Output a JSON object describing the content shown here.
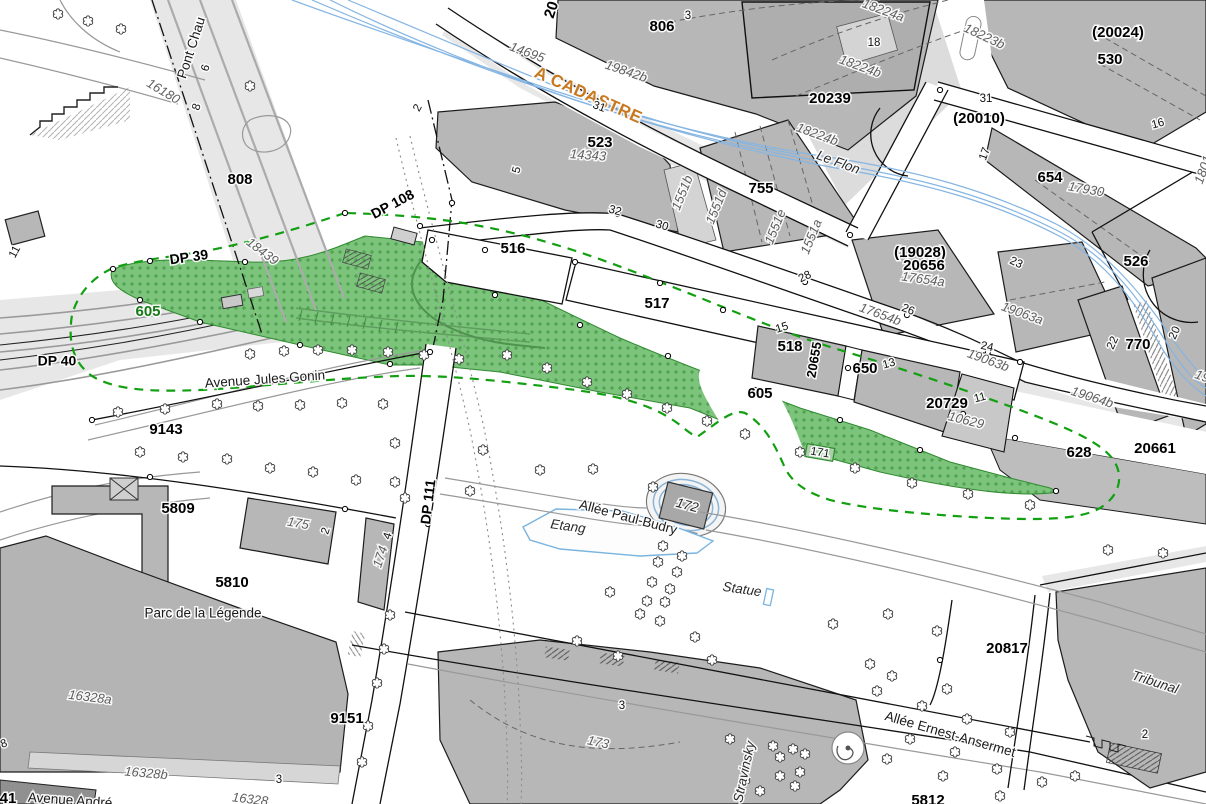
{
  "meta": {
    "kind": "cadastral-plan",
    "highlighted_parcel": "605",
    "river_name": "Le Flon",
    "park_name": "Parc de la Légende"
  },
  "colors": {
    "building": "#b7b7b7",
    "building_light": "#d4d4d4",
    "highlight_green": "#7cc47c",
    "highlight_green_mark": "#459a45",
    "green_boundary": "#12a012",
    "river_blue": "#85b5e3",
    "water_outline": "#7ab4e0",
    "cadastre_orange": "#c8791f",
    "green_label": "#157a15"
  },
  "labels": [
    {
      "t": "Pont Chau",
      "x": 192,
      "y": 48,
      "r": -72,
      "c": "street"
    },
    {
      "t": "6",
      "x": 206,
      "y": 68,
      "r": -72,
      "c": "num"
    },
    {
      "t": "16180",
      "x": 163,
      "y": 92,
      "r": 31,
      "c": "sub"
    },
    {
      "t": "8",
      "x": 197,
      "y": 107,
      "r": -72,
      "c": "num"
    },
    {
      "t": "808",
      "x": 240,
      "y": 180,
      "r": 0,
      "c": "parcel"
    },
    {
      "t": "18439",
      "x": 262,
      "y": 252,
      "r": 37,
      "c": "sub"
    },
    {
      "t": "DP 39",
      "x": 189,
      "y": 258,
      "r": -8,
      "c": "dp"
    },
    {
      "t": "DP 40",
      "x": 57,
      "y": 362,
      "r": 0,
      "c": "dp"
    },
    {
      "t": "11",
      "x": 15,
      "y": 252,
      "r": -62,
      "c": "num"
    },
    {
      "t": "605",
      "x": 148,
      "y": 312,
      "r": 0,
      "c": "green-label"
    },
    {
      "t": "DP 108",
      "x": 393,
      "y": 205,
      "r": -28,
      "c": "dp"
    },
    {
      "t": "Avenue Jules Gonin",
      "x": 265,
      "y": 380,
      "r": -4,
      "c": "street"
    },
    {
      "t": "9143",
      "x": 166,
      "y": 430,
      "r": 0,
      "c": "parcel"
    },
    {
      "t": "20",
      "x": 552,
      "y": 10,
      "r": -72,
      "c": "parcel"
    },
    {
      "t": "14695",
      "x": 527,
      "y": 53,
      "r": 20,
      "c": "sub"
    },
    {
      "t": "19842b",
      "x": 626,
      "y": 72,
      "r": 19,
      "c": "sub"
    },
    {
      "t": "A CADASTRE",
      "x": 588,
      "y": 96,
      "r": 24,
      "c": "cadastre"
    },
    {
      "t": "806",
      "x": 662,
      "y": 27,
      "r": 0,
      "c": "parcel"
    },
    {
      "t": "3",
      "x": 688,
      "y": 16,
      "r": 0,
      "c": "num"
    },
    {
      "t": "31",
      "x": 599,
      "y": 107,
      "r": 20,
      "c": "num"
    },
    {
      "t": "523",
      "x": 600,
      "y": 143,
      "r": 0,
      "c": "parcel"
    },
    {
      "t": "14343",
      "x": 588,
      "y": 156,
      "r": 4,
      "c": "sub"
    },
    {
      "t": "5",
      "x": 517,
      "y": 170,
      "r": -75,
      "c": "num"
    },
    {
      "t": "2",
      "x": 418,
      "y": 108,
      "r": -62,
      "c": "num"
    },
    {
      "t": "32",
      "x": 615,
      "y": 211,
      "r": 16,
      "c": "num"
    },
    {
      "t": "30",
      "x": 662,
      "y": 226,
      "r": 16,
      "c": "num"
    },
    {
      "t": "1551b",
      "x": 683,
      "y": 193,
      "r": -68,
      "c": "sub"
    },
    {
      "t": "1551d",
      "x": 717,
      "y": 207,
      "r": -68,
      "c": "sub"
    },
    {
      "t": "755",
      "x": 761,
      "y": 189,
      "r": 0,
      "c": "parcel"
    },
    {
      "t": "1551e",
      "x": 776,
      "y": 227,
      "r": -68,
      "c": "sub"
    },
    {
      "t": "1551a",
      "x": 812,
      "y": 237,
      "r": -68,
      "c": "sub"
    },
    {
      "t": "28",
      "x": 805,
      "y": 277,
      "r": -25,
      "c": "num"
    },
    {
      "t": "18224a",
      "x": 883,
      "y": 11,
      "r": 20,
      "c": "sub"
    },
    {
      "t": "18",
      "x": 874,
      "y": 43,
      "r": 0,
      "c": "num"
    },
    {
      "t": "18224b",
      "x": 860,
      "y": 67,
      "r": 20,
      "c": "sub"
    },
    {
      "t": "20239",
      "x": 830,
      "y": 99,
      "r": 0,
      "c": "parcel"
    },
    {
      "t": "18223b",
      "x": 984,
      "y": 37,
      "r": 25,
      "c": "sub"
    },
    {
      "t": "(20024)",
      "x": 1118,
      "y": 33,
      "r": 0,
      "c": "parcel"
    },
    {
      "t": "530",
      "x": 1110,
      "y": 60,
      "r": 0,
      "c": "parcel"
    },
    {
      "t": "18224b",
      "x": 817,
      "y": 135,
      "r": 20,
      "c": "sub"
    },
    {
      "t": "Le Flon",
      "x": 838,
      "y": 163,
      "r": 20,
      "c": "street-it"
    },
    {
      "t": "31",
      "x": 986,
      "y": 99,
      "r": 0,
      "c": "num"
    },
    {
      "t": "(20010)",
      "x": 979,
      "y": 119,
      "r": 0,
      "c": "parcel"
    },
    {
      "t": "16",
      "x": 1158,
      "y": 124,
      "r": -15,
      "c": "num"
    },
    {
      "t": "17",
      "x": 985,
      "y": 154,
      "r": -70,
      "c": "num"
    },
    {
      "t": "654",
      "x": 1050,
      "y": 178,
      "r": 0,
      "c": "parcel"
    },
    {
      "t": "17930",
      "x": 1086,
      "y": 190,
      "r": 10,
      "c": "sub"
    },
    {
      "t": "1801",
      "x": 1204,
      "y": 170,
      "r": -70,
      "c": "sub"
    },
    {
      "t": "526",
      "x": 1136,
      "y": 262,
      "r": 0,
      "c": "parcel"
    },
    {
      "t": "(19028)",
      "x": 920,
      "y": 253,
      "r": 0,
      "c": "parcel"
    },
    {
      "t": "20656",
      "x": 924,
      "y": 266,
      "r": 0,
      "c": "parcel"
    },
    {
      "t": "17654a",
      "x": 923,
      "y": 280,
      "r": 8,
      "c": "sub"
    },
    {
      "t": "23",
      "x": 1016,
      "y": 263,
      "r": 25,
      "c": "num"
    },
    {
      "t": "26",
      "x": 908,
      "y": 310,
      "r": 22,
      "c": "num"
    },
    {
      "t": "17654b",
      "x": 880,
      "y": 315,
      "r": 20,
      "c": "sub"
    },
    {
      "t": "19063a",
      "x": 1022,
      "y": 314,
      "r": 20,
      "c": "sub"
    },
    {
      "t": "24",
      "x": 987,
      "y": 347,
      "r": 12,
      "c": "num"
    },
    {
      "t": "19063b",
      "x": 988,
      "y": 361,
      "r": 20,
      "c": "sub"
    },
    {
      "t": "22",
      "x": 1113,
      "y": 343,
      "r": -65,
      "c": "num"
    },
    {
      "t": "770",
      "x": 1138,
      "y": 345,
      "r": 0,
      "c": "parcel"
    },
    {
      "t": "20",
      "x": 1175,
      "y": 333,
      "r": -65,
      "c": "num"
    },
    {
      "t": "19064b",
      "x": 1092,
      "y": 398,
      "r": 18,
      "c": "sub"
    },
    {
      "t": "19",
      "x": 1202,
      "y": 377,
      "r": 20,
      "c": "sub"
    },
    {
      "t": "516",
      "x": 513,
      "y": 249,
      "r": 0,
      "c": "parcel"
    },
    {
      "t": "517",
      "x": 657,
      "y": 304,
      "r": 0,
      "c": "parcel"
    },
    {
      "t": "15",
      "x": 782,
      "y": 328,
      "r": -18,
      "c": "num"
    },
    {
      "t": "518",
      "x": 790,
      "y": 347,
      "r": 0,
      "c": "parcel"
    },
    {
      "t": "20655",
      "x": 815,
      "y": 360,
      "r": -80,
      "c": "parcel-sm"
    },
    {
      "t": "650",
      "x": 865,
      "y": 369,
      "r": 0,
      "c": "parcel"
    },
    {
      "t": "13",
      "x": 889,
      "y": 364,
      "r": -15,
      "c": "num"
    },
    {
      "t": "20729",
      "x": 947,
      "y": 404,
      "r": 0,
      "c": "parcel"
    },
    {
      "t": "11",
      "x": 980,
      "y": 398,
      "r": -15,
      "c": "num"
    },
    {
      "t": "10629",
      "x": 966,
      "y": 421,
      "r": 14,
      "c": "sub"
    },
    {
      "t": "605",
      "x": 760,
      "y": 394,
      "r": 0,
      "c": "parcel"
    },
    {
      "t": "171",
      "x": 820,
      "y": 453,
      "r": 10,
      "c": "num"
    },
    {
      "t": "628",
      "x": 1079,
      "y": 453,
      "r": 0,
      "c": "parcel"
    },
    {
      "t": "20661",
      "x": 1155,
      "y": 449,
      "r": 0,
      "c": "parcel"
    },
    {
      "t": "Etang",
      "x": 568,
      "y": 527,
      "r": 8,
      "c": "street-it"
    },
    {
      "t": "Allée Paul-Budry",
      "x": 628,
      "y": 518,
      "r": 15,
      "c": "street"
    },
    {
      "t": "172",
      "x": 687,
      "y": 506,
      "r": 15,
      "c": "street-it"
    },
    {
      "t": "Statue",
      "x": 742,
      "y": 590,
      "r": 8,
      "c": "street-it"
    },
    {
      "t": "DP 111",
      "x": 429,
      "y": 502,
      "r": -83,
      "c": "dp"
    },
    {
      "t": "5809",
      "x": 178,
      "y": 509,
      "r": 0,
      "c": "parcel"
    },
    {
      "t": "175",
      "x": 298,
      "y": 524,
      "r": 10,
      "c": "sub"
    },
    {
      "t": "2",
      "x": 326,
      "y": 531,
      "r": -72,
      "c": "num"
    },
    {
      "t": "4",
      "x": 388,
      "y": 536,
      "r": -72,
      "c": "num"
    },
    {
      "t": "174",
      "x": 381,
      "y": 557,
      "r": -72,
      "c": "sub"
    },
    {
      "t": "5810",
      "x": 232,
      "y": 583,
      "r": 0,
      "c": "parcel"
    },
    {
      "t": "Parc de la Légende",
      "x": 203,
      "y": 614,
      "r": 0,
      "c": "street"
    },
    {
      "t": "16328a",
      "x": 90,
      "y": 698,
      "r": 7,
      "c": "sub"
    },
    {
      "t": "9151",
      "x": 347,
      "y": 719,
      "r": 0,
      "c": "parcel"
    },
    {
      "t": "16328b",
      "x": 146,
      "y": 774,
      "r": 5,
      "c": "sub"
    },
    {
      "t": "3",
      "x": 279,
      "y": 780,
      "r": 0,
      "c": "num"
    },
    {
      "t": "16328",
      "x": 250,
      "y": 800,
      "r": 7,
      "c": "sub"
    },
    {
      "t": "41",
      "x": 8,
      "y": 799,
      "r": 0,
      "c": "parcel"
    },
    {
      "t": "Avenue André",
      "x": 70,
      "y": 801,
      "r": 4,
      "c": "street"
    },
    {
      "t": "8",
      "x": 4,
      "y": 744,
      "r": -20,
      "c": "num"
    },
    {
      "t": "173",
      "x": 598,
      "y": 743,
      "r": 12,
      "c": "sub"
    },
    {
      "t": "3",
      "x": 622,
      "y": 706,
      "r": 0,
      "c": "num"
    },
    {
      "t": "Stravinsky",
      "x": 745,
      "y": 772,
      "r": -78,
      "c": "street-it"
    },
    {
      "t": "Allée Ernest-Ansermet",
      "x": 950,
      "y": 735,
      "r": 16,
      "c": "street"
    },
    {
      "t": "20817",
      "x": 1007,
      "y": 649,
      "r": 0,
      "c": "parcel"
    },
    {
      "t": "Tribunal",
      "x": 1155,
      "y": 683,
      "r": 18,
      "c": "street-it"
    },
    {
      "t": "2",
      "x": 1145,
      "y": 735,
      "r": 0,
      "c": "num"
    },
    {
      "t": "5812",
      "x": 928,
      "y": 801,
      "r": 0,
      "c": "parcel"
    }
  ],
  "trees": [
    [
      250,
      354
    ],
    [
      284,
      351
    ],
    [
      318,
      350
    ],
    [
      352,
      350
    ],
    [
      388,
      352
    ],
    [
      424,
      355
    ],
    [
      459,
      359
    ],
    [
      507,
      355
    ],
    [
      547,
      368
    ],
    [
      587,
      382
    ],
    [
      627,
      394
    ],
    [
      667,
      408
    ],
    [
      707,
      421
    ],
    [
      745,
      434
    ],
    [
      800,
      452
    ],
    [
      855,
      468
    ],
    [
      912,
      483
    ],
    [
      968,
      494
    ],
    [
      1030,
      505
    ],
    [
      1108,
      550
    ],
    [
      1163,
      553
    ],
    [
      217,
      404
    ],
    [
      258,
      406
    ],
    [
      300,
      405
    ],
    [
      342,
      403
    ],
    [
      383,
      404
    ],
    [
      118,
      412
    ],
    [
      165,
      409
    ],
    [
      140,
      452
    ],
    [
      183,
      457
    ],
    [
      227,
      459
    ],
    [
      270,
      468
    ],
    [
      313,
      472
    ],
    [
      356,
      480
    ],
    [
      395,
      443
    ],
    [
      395,
      482
    ],
    [
      405,
      498
    ],
    [
      483,
      450
    ],
    [
      470,
      491
    ],
    [
      540,
      470
    ],
    [
      593,
      469
    ],
    [
      653,
      487
    ],
    [
      663,
      546
    ],
    [
      682,
      556
    ],
    [
      658,
      562
    ],
    [
      677,
      572
    ],
    [
      652,
      582
    ],
    [
      670,
      589
    ],
    [
      647,
      601
    ],
    [
      665,
      602
    ],
    [
      640,
      614
    ],
    [
      660,
      621
    ],
    [
      610,
      592
    ],
    [
      577,
      641
    ],
    [
      618,
      656
    ],
    [
      695,
      637
    ],
    [
      712,
      660
    ],
    [
      390,
      615
    ],
    [
      384,
      649
    ],
    [
      377,
      683
    ],
    [
      368,
      726
    ],
    [
      362,
      762
    ],
    [
      833,
      624
    ],
    [
      888,
      614
    ],
    [
      937,
      631
    ],
    [
      870,
      664
    ],
    [
      892,
      676
    ],
    [
      877,
      691
    ],
    [
      922,
      706
    ],
    [
      947,
      689
    ],
    [
      967,
      719
    ],
    [
      1010,
      732
    ],
    [
      910,
      739
    ],
    [
      955,
      752
    ],
    [
      887,
      759
    ],
    [
      943,
      776
    ],
    [
      997,
      769
    ],
    [
      1042,
      782
    ],
    [
      1000,
      796
    ],
    [
      1075,
      776
    ],
    [
      730,
      739
    ],
    [
      773,
      746
    ],
    [
      793,
      749
    ],
    [
      805,
      754
    ],
    [
      780,
      757
    ],
    [
      800,
      772
    ],
    [
      780,
      776
    ],
    [
      795,
      786
    ],
    [
      760,
      791
    ],
    [
      745,
      780
    ],
    [
      58,
      14
    ],
    [
      88,
      21
    ],
    [
      121,
      29
    ],
    [
      250,
      86
    ]
  ],
  "markers": [
    [
      113,
      269
    ],
    [
      150,
      261
    ],
    [
      245,
      262
    ],
    [
      345,
      213
    ],
    [
      420,
      226
    ],
    [
      432,
      240
    ],
    [
      452,
      203
    ],
    [
      485,
      250
    ],
    [
      575,
      262
    ],
    [
      618,
      214
    ],
    [
      660,
      283
    ],
    [
      723,
      310
    ],
    [
      805,
      282
    ],
    [
      848,
      368
    ],
    [
      907,
      315
    ],
    [
      920,
      450
    ],
    [
      963,
      414
    ],
    [
      988,
      352
    ],
    [
      1015,
      438
    ],
    [
      1056,
      491
    ],
    [
      840,
      420
    ],
    [
      755,
      390
    ],
    [
      668,
      356
    ],
    [
      580,
      325
    ],
    [
      495,
      295
    ],
    [
      430,
      352
    ],
    [
      390,
      364
    ],
    [
      300,
      345
    ],
    [
      200,
      322
    ],
    [
      140,
      300
    ],
    [
      92,
      420
    ],
    [
      150,
      477
    ],
    [
      345,
      509
    ],
    [
      428,
      524
    ],
    [
      940,
      660
    ],
    [
      1020,
      362
    ],
    [
      850,
      235
    ],
    [
      940,
      90
    ]
  ]
}
